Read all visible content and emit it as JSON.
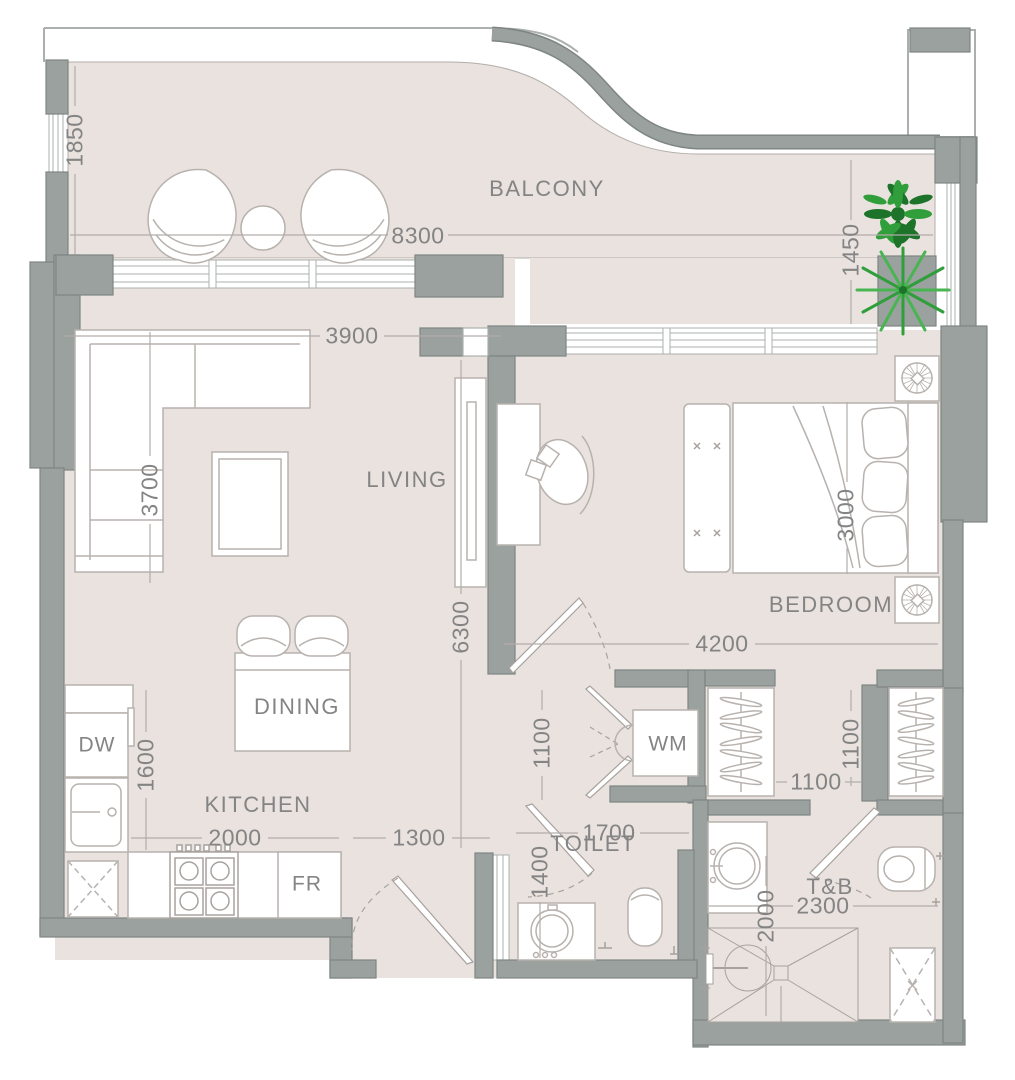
{
  "colors": {
    "floor": "#e9e2de",
    "wall": "#9aa19f",
    "wall_line": "#7e8583",
    "furn": "#b8b2ae",
    "fixture": "#a8a29e",
    "dim_line": "#b3adaa",
    "band": "#abb0ae",
    "text": "#848484",
    "plant_dark": "#1d7329",
    "plant_mid": "#2f9e3b",
    "plant_light": "#49b552"
  },
  "labels": {
    "balcony": "BALCONY",
    "living": "LIVING",
    "dining": "DINING",
    "kitchen": "KITCHEN",
    "bedroom": "BEDROOM",
    "toilet": "TOILET",
    "tb": "T&B",
    "dw": "DW",
    "fr": "FR",
    "wm": "WM"
  },
  "dims": {
    "balcony_side_left": "1850",
    "balcony_width": "8300",
    "balcony_side_right": "1450",
    "living_width": "3900",
    "living_side": "3700",
    "living_length": "6300",
    "bed_width": "3000",
    "bedroom_width": "4200",
    "kitchen_side": "1600",
    "kitchen_width": "2000",
    "entry_width": "1300",
    "hall_width": "1100",
    "toilet_side": "1400",
    "toilet_width": "1700",
    "dressing_width": "1100",
    "dressing_depth": "1100",
    "tb_width": "2300",
    "tb_depth": "2000"
  }
}
